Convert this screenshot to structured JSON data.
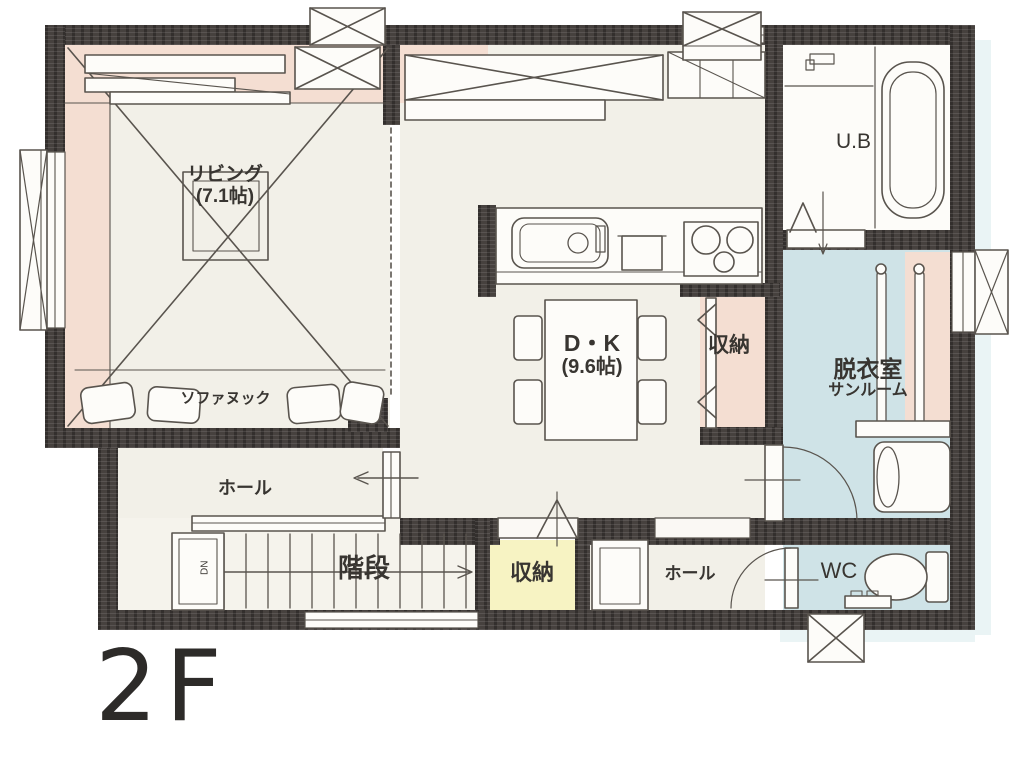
{
  "floor_label": "2F",
  "rooms": {
    "living": {
      "name": "リビング",
      "area": "(7.1帖)"
    },
    "sofa_nook": {
      "name": "ソファヌック"
    },
    "dk": {
      "name": "D・K",
      "area": "(9.6帖)"
    },
    "dk_closet": {
      "name": "収納"
    },
    "unit_bath": {
      "name": "U.B"
    },
    "dressing": {
      "name": "脱衣室",
      "subname": "サンルーム"
    },
    "wc": {
      "name": "WC"
    },
    "hall_upper": {
      "name": "ホール"
    },
    "hall_lower": {
      "name": "ホール"
    },
    "stairs": {
      "name": "階段",
      "direction": "DN"
    },
    "storage_lower": {
      "name": "収納"
    }
  },
  "colors": {
    "wall": "#46413e",
    "floor_cream": "#f2f0e8",
    "floor_blue": "#cfe3e7",
    "floor_yellow": "#f7f3c3",
    "accent_peach": "#f4ded2",
    "linework": "#59544e"
  }
}
